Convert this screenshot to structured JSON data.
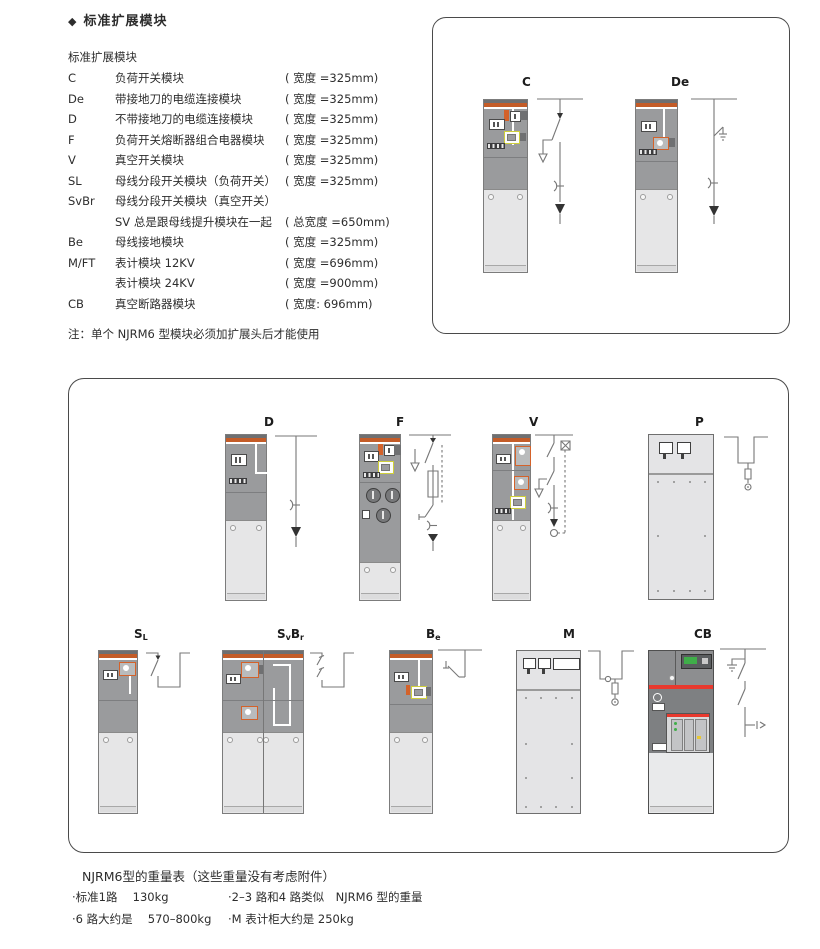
{
  "doc": {
    "bullet": "◆",
    "title": "标准扩展模块",
    "list_heading": "标准扩展模块",
    "modules": [
      {
        "code": "C",
        "name": "负荷开关模块",
        "width": "( 宽度 =325mm)"
      },
      {
        "code": "De",
        "name": "带接地刀的电缆连接模块",
        "width": "( 宽度 =325mm)"
      },
      {
        "code": "D",
        "name": "不带接地刀的电缆连接模块",
        "width": "( 宽度 =325mm)"
      },
      {
        "code": "F",
        "name": "负荷开关熔断器组合电器模块",
        "width": "( 宽度 =325mm)"
      },
      {
        "code": "V",
        "name": "真空开关模块",
        "width": "( 宽度 =325mm)"
      },
      {
        "code": "SL",
        "name": "母线分段开关模块（负荷开关）",
        "width": "( 宽度 =325mm)"
      },
      {
        "code": "SvBr",
        "name": "母线分段开关模块（真空开关）",
        "width": ""
      },
      {
        "code": "",
        "name": "SV 总是跟母线提升模块在一起",
        "width": "( 总宽度 =650mm)"
      },
      {
        "code": "Be",
        "name": "母线接地模块",
        "width": "( 宽度 =325mm)"
      },
      {
        "code": "M/FT",
        "name": "表计模块 12KV",
        "width": "( 宽度 =696mm)"
      },
      {
        "code": "",
        "name": "表计模块 24KV",
        "width": "( 宽度 =900mm)"
      },
      {
        "code": "CB",
        "name": "真空断路器模块",
        "width": "( 宽度: 696mm)"
      }
    ],
    "note": "注：单个 NJRM6 型模块必须加扩展头后才能使用"
  },
  "figures": {
    "top": [
      {
        "label": "C"
      },
      {
        "label": "De"
      }
    ],
    "row1": [
      {
        "label": "D"
      },
      {
        "label": "F"
      },
      {
        "label": "V"
      },
      {
        "label": "P"
      }
    ],
    "row2": {
      "sl": {
        "main": "S",
        "sub": "L"
      },
      "svbr": {
        "p1": "S",
        "p2": "v",
        "p3": "B",
        "p4": "r"
      },
      "be": {
        "main": "B",
        "sub": "e"
      },
      "m": {
        "label": "M"
      },
      "cb": {
        "label": "CB"
      }
    }
  },
  "weights": {
    "heading": "NJRM6型的重量表（这些重量没有考虑附件）",
    "col1": [
      "·标准1路　 130kg",
      "·6 路大约是　 570–800kg"
    ],
    "col2": [
      "·2–3 路和4 路类似　NJRM6 型的重量",
      "·M 表计柜大约是 250kg"
    ]
  },
  "colors": {
    "cabinet_orange": "#c45c28",
    "cabinet_gray": "#9a9b9d",
    "cabinet_light": "#e6e6e7",
    "cb_red": "#e8392e",
    "cb_screen_green": "#3fae49"
  }
}
